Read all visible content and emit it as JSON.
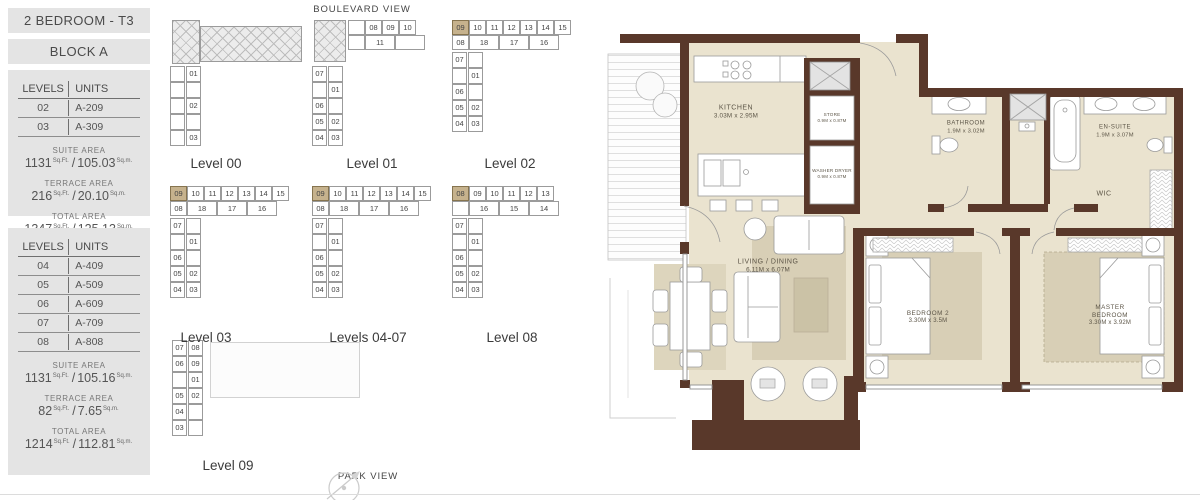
{
  "page": {
    "title": "2 BEDROOM - T3",
    "block": "BLOCK A",
    "boulevard_view": "BOULEVARD VIEW",
    "park_view": "PARK VIEW"
  },
  "info_panels": [
    {
      "table": {
        "col1": "LEVELS",
        "col2": "UNITS",
        "rows": [
          [
            "02",
            "A-209"
          ],
          [
            "03",
            "A-309"
          ]
        ]
      },
      "areas": [
        {
          "label": "SUITE AREA",
          "v1": "1131",
          "u1": "Sq.Ft.",
          "sep": "/",
          "v2": "105.03",
          "u2": "Sq.m."
        },
        {
          "label": "TERRACE AREA",
          "v1": "216",
          "u1": "Sq.Ft.",
          "sep": "/",
          "v2": "20.10",
          "u2": "Sq.m."
        },
        {
          "label": "TOTAL AREA",
          "v1": "1347",
          "u1": "Sq.Ft.",
          "sep": "/",
          "v2": "125.13",
          "u2": "Sq.m."
        }
      ]
    },
    {
      "table": {
        "col1": "LEVELS",
        "col2": "UNITS",
        "rows": [
          [
            "04",
            "A-409"
          ],
          [
            "05",
            "A-509"
          ],
          [
            "06",
            "A-609"
          ],
          [
            "07",
            "A-709"
          ],
          [
            "08",
            "A-808"
          ]
        ]
      },
      "areas": [
        {
          "label": "SUITE AREA",
          "v1": "1131",
          "u1": "Sq.Ft.",
          "sep": "/",
          "v2": "105.16",
          "u2": "Sq.m."
        },
        {
          "label": "TERRACE AREA",
          "v1": "82",
          "u1": "Sq.Ft.",
          "sep": "/",
          "v2": "7.65",
          "u2": "Sq.m."
        },
        {
          "label": "TOTAL AREA",
          "v1": "1214",
          "u1": "Sq.Ft.",
          "sep": "/",
          "v2": "112.81",
          "u2": "Sq.m."
        }
      ]
    }
  ],
  "keyplans": [
    {
      "label": "Level 00",
      "highlight": null,
      "row1": [],
      "row2": [],
      "vertical": [
        [
          "",
          "01"
        ],
        [
          "",
          ""
        ],
        [
          "",
          "02"
        ],
        [
          "",
          ""
        ],
        [
          "",
          "03"
        ]
      ],
      "hatch": [
        {
          "x": 2,
          "y": 0,
          "w": 28,
          "h": 44
        },
        {
          "x": 30,
          "y": 6,
          "w": 102,
          "h": 36
        }
      ],
      "rx": 0,
      "vy": 46
    },
    {
      "label": "Level 01",
      "highlight": null,
      "row1": [
        "",
        "08",
        "09",
        "10"
      ],
      "row2": [
        "",
        "11",
        ""
      ],
      "vertical": [
        [
          "07",
          ""
        ],
        [
          "",
          "01"
        ],
        [
          "06",
          ""
        ],
        [
          "05",
          "02"
        ],
        [
          "04",
          "03"
        ]
      ],
      "hatch": [
        {
          "x": 2,
          "y": 0,
          "w": 32,
          "h": 42
        }
      ],
      "rx": 36,
      "vy": 46
    },
    {
      "label": "Level 02",
      "highlight": "09",
      "row1": [
        "09",
        "10",
        "11",
        "12",
        "13",
        "14",
        "15"
      ],
      "row2": [
        "08",
        "18",
        "17",
        "16"
      ],
      "vertical": [
        [
          "07",
          ""
        ],
        [
          "",
          "01"
        ],
        [
          "06",
          ""
        ],
        [
          "05",
          "02"
        ],
        [
          "04",
          "03"
        ]
      ],
      "hatch": [],
      "rx": 0,
      "vy": null
    },
    {
      "label": "Level 03",
      "highlight": "09",
      "row1": [
        "09",
        "10",
        "11",
        "12",
        "13",
        "14",
        "15"
      ],
      "row2": [
        "08",
        "18",
        "17",
        "16"
      ],
      "vertical": [
        [
          "07",
          ""
        ],
        [
          "",
          "01"
        ],
        [
          "06",
          ""
        ],
        [
          "05",
          "02"
        ],
        [
          "04",
          "03"
        ]
      ],
      "hatch": [],
      "rx": 0,
      "vy": null
    },
    {
      "label": "Levels 04-07",
      "highlight": "09",
      "row1": [
        "09",
        "10",
        "11",
        "12",
        "13",
        "14",
        "15"
      ],
      "row2": [
        "08",
        "18",
        "17",
        "16"
      ],
      "vertical": [
        [
          "07",
          ""
        ],
        [
          "",
          "01"
        ],
        [
          "06",
          ""
        ],
        [
          "05",
          "02"
        ],
        [
          "04",
          "03"
        ]
      ],
      "hatch": [],
      "rx": 0,
      "vy": null
    },
    {
      "label": "Level 08",
      "highlight": "08",
      "row1": [
        "08",
        "09",
        "10",
        "11",
        "12",
        "13"
      ],
      "row2": [
        "",
        "16",
        "15",
        "14"
      ],
      "vertical": [
        [
          "07",
          ""
        ],
        [
          "",
          "01"
        ],
        [
          "06",
          ""
        ],
        [
          "05",
          "02"
        ],
        [
          "04",
          "03"
        ]
      ],
      "hatch": [],
      "rx": 0,
      "vy": null
    },
    {
      "label": "Level 09",
      "highlight": null,
      "row1": [],
      "row2": [],
      "vertical": [
        [
          "07",
          "08"
        ],
        [
          "06",
          "09"
        ],
        [
          "",
          "01"
        ],
        [
          "05",
          "02"
        ],
        [
          "04",
          ""
        ],
        [
          "03",
          ""
        ]
      ],
      "hatch": [
        {
          "x": 38,
          "y": 2,
          "w": 150,
          "h": 56,
          "ghost": true
        }
      ],
      "rx": 0,
      "vy": 0
    }
  ],
  "floorplan": {
    "rooms": {
      "kitchen": {
        "name": "KITCHEN",
        "dims": "3.03M x 2.95M"
      },
      "store": {
        "name": "STORE",
        "dims": "0.9M x 0.87M"
      },
      "washer": {
        "name": "WASHER DRYER",
        "dims": "0.9M x 0.87M"
      },
      "bathroom": {
        "name": "BATHROOM",
        "dims": "1.9M x 3.02M"
      },
      "ensuite": {
        "name": "EN-SUITE",
        "dims": "1.9M x 3.07M"
      },
      "wic": {
        "name": "WIC"
      },
      "living": {
        "name": "LIVING / DINING",
        "dims": "6.11M x 6.07M"
      },
      "bedroom2": {
        "name": "BEDROOM 2",
        "dims": "3.30M x 3.5M"
      },
      "master": {
        "name": "MASTER BEDROOM",
        "dims": "3.30M x 3.92M"
      }
    },
    "colors": {
      "wall": "#59382a",
      "floor": "#eae3cf",
      "rug": "#d8cfb6",
      "highlight": "#c6b28d"
    }
  }
}
